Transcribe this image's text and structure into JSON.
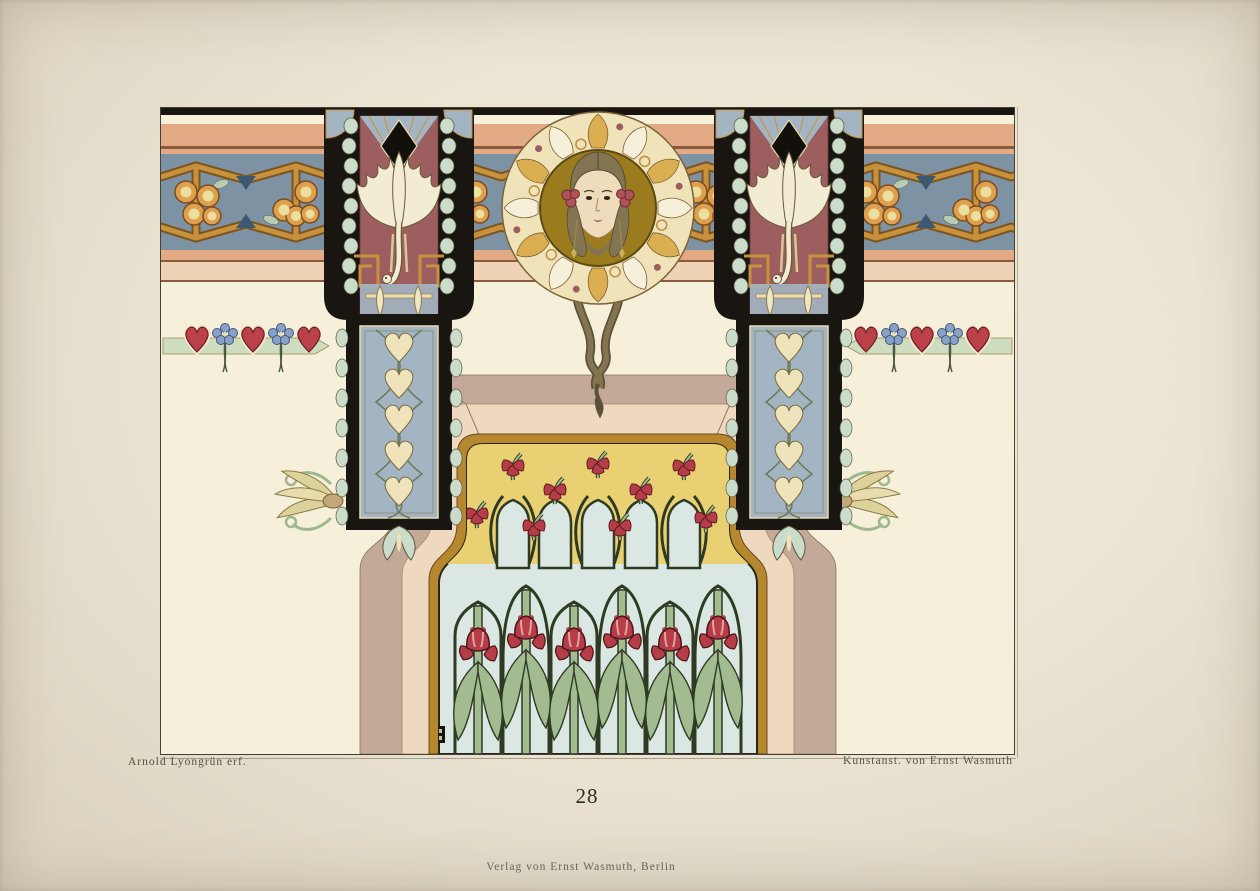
{
  "document": {
    "kind": "printed_art_plate",
    "description": "Art Nouveau wall decoration design plate: frieze with berry garland, winged swan pilasters, female head medallion and flower-filled window niche",
    "plate_number": "28",
    "captions": {
      "designer_credit": "Arnold Lyongrün erf.",
      "printer_credit": "Kunstanst. von Ernst Wasmuth",
      "publisher_line": "Verlag von Ernst Wasmuth, Berlin"
    }
  },
  "colors": {
    "paper": "#ebe4d3",
    "plate_cream": "#f6efd9",
    "ink": "#191611",
    "salmon": "#e3aa86",
    "salmon_light": "#eed3b6",
    "rule_brown": "#8a5a3a",
    "frieze_blue": "#7d93a3",
    "gold": "#c8913b",
    "gold_dark": "#7c5420",
    "berry": "#dfa04e",
    "berry_light": "#ece0a0",
    "maroon": "#9d5e60",
    "leaf_pale": "#ccdcca",
    "shaft_blue": "#a3b4c2",
    "heart_cream": "#efe3bc",
    "medallion_gold": "#9a7b1e",
    "wreath_cream": "#f0e3ba",
    "wreath_gold": "#dcae52",
    "skin": "#eedcbc",
    "hair": "#837452",
    "taupe": "#c3aa98",
    "bevel_pink": "#eed8c0",
    "frame_gold": "#b5872f",
    "window_yellow": "#e9d173",
    "window_blue": "#dbe7e2",
    "stem_green": "#a3bb90",
    "stem_dark": "#2e3a22",
    "flower_red": "#b43d47",
    "flower_light": "#e2a09e",
    "heart_red": "#bc4049",
    "flower_blue": "#87a2c6",
    "ribbon_green": "#cedcc0",
    "swan_cream": "#f3ecd4",
    "text": "#55503f"
  }
}
